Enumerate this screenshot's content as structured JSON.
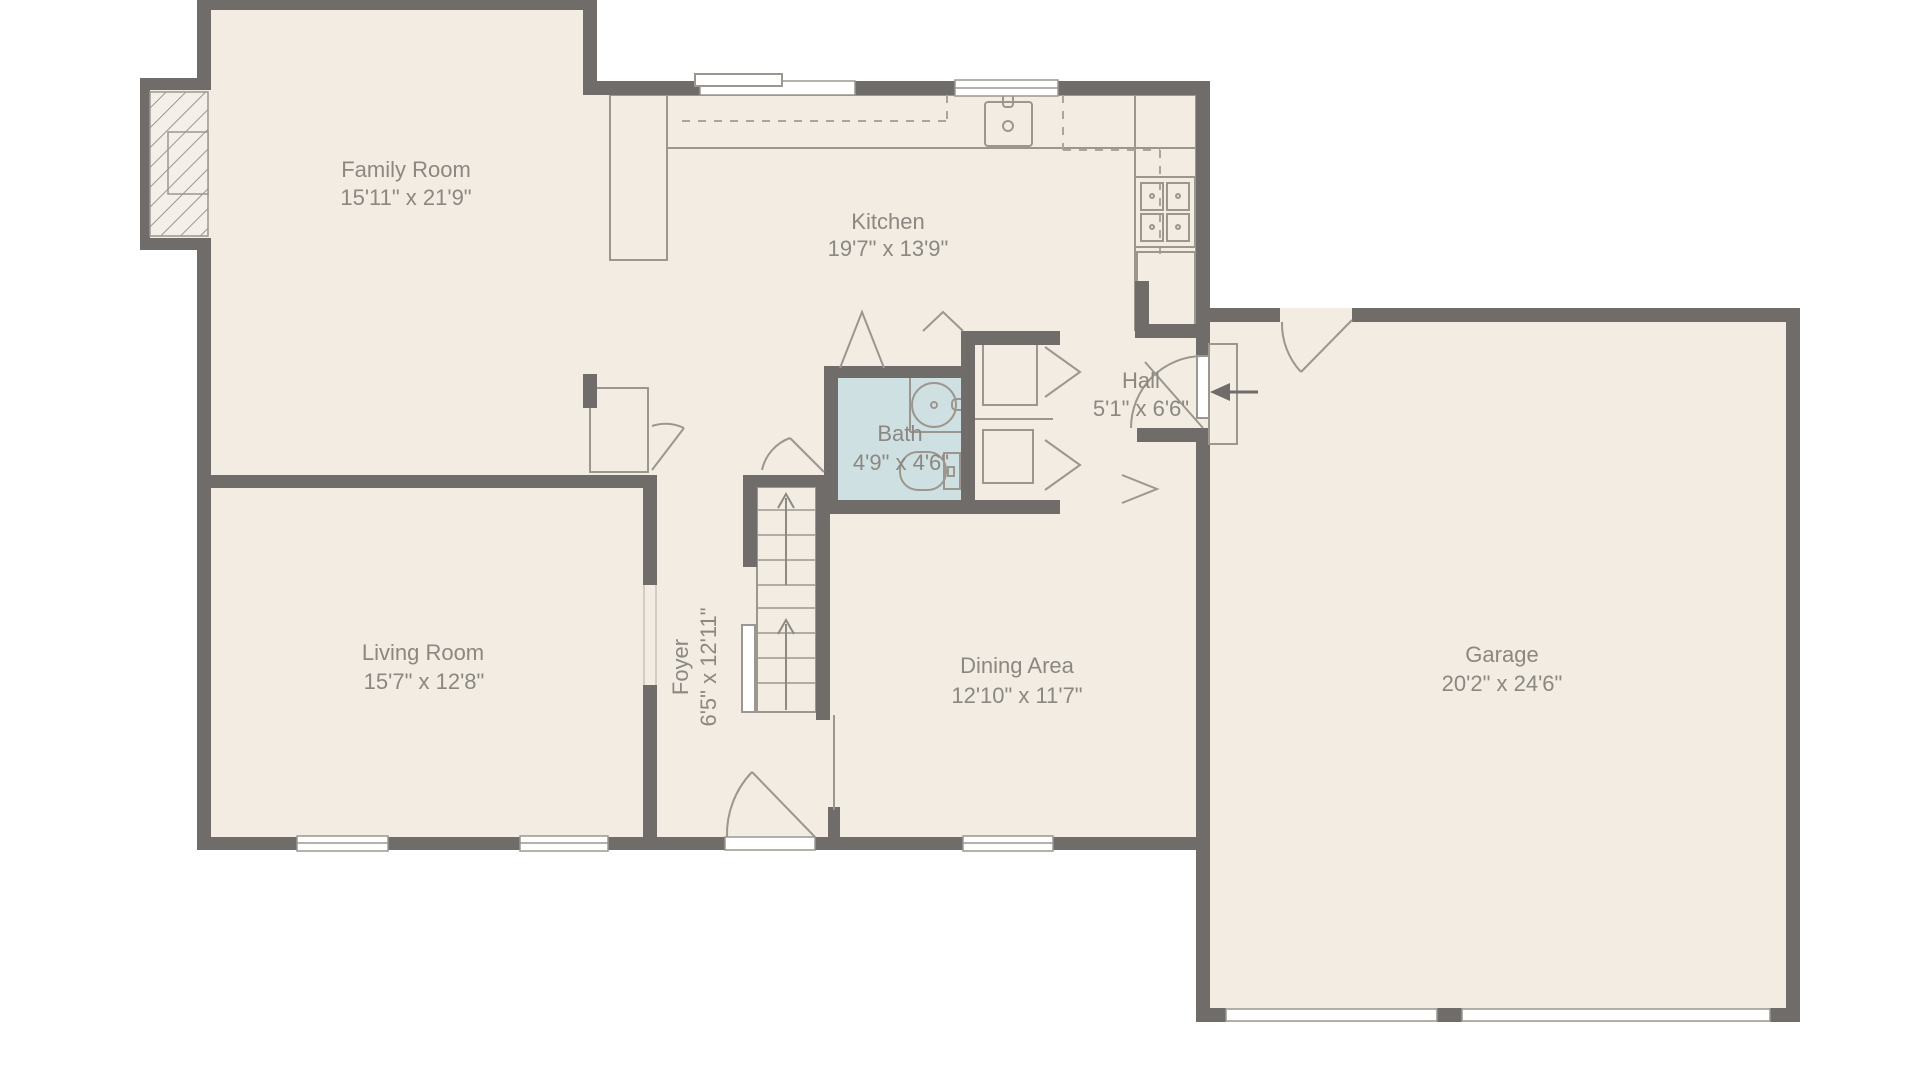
{
  "plan": {
    "type": "floor-plan",
    "rooms": [
      {
        "name": "Family Room",
        "dims": "15'11\" x 21'9\""
      },
      {
        "name": "Kitchen",
        "dims": "19'7\" x 13'9\""
      },
      {
        "name": "Hall",
        "dims": "5'1\" x 6'6\""
      },
      {
        "name": "Bath",
        "dims": "4'9\" x 4'6\""
      },
      {
        "name": "Living Room",
        "dims": "15'7\" x 12'8\""
      },
      {
        "name": "Foyer",
        "dims": "6'5\" x 12'11\""
      },
      {
        "name": "Dining Area",
        "dims": "12'10\" x 11'7\""
      },
      {
        "name": "Garage",
        "dims": "20'2\" x 24'6\""
      }
    ],
    "colors": {
      "wall": "#6f6c69",
      "room_fill": "#f2ece3",
      "bath_fill": "#cfe0e3",
      "label_text": "#8b8781",
      "fixture_line": "#9b978f",
      "background": "#ffffff"
    }
  }
}
